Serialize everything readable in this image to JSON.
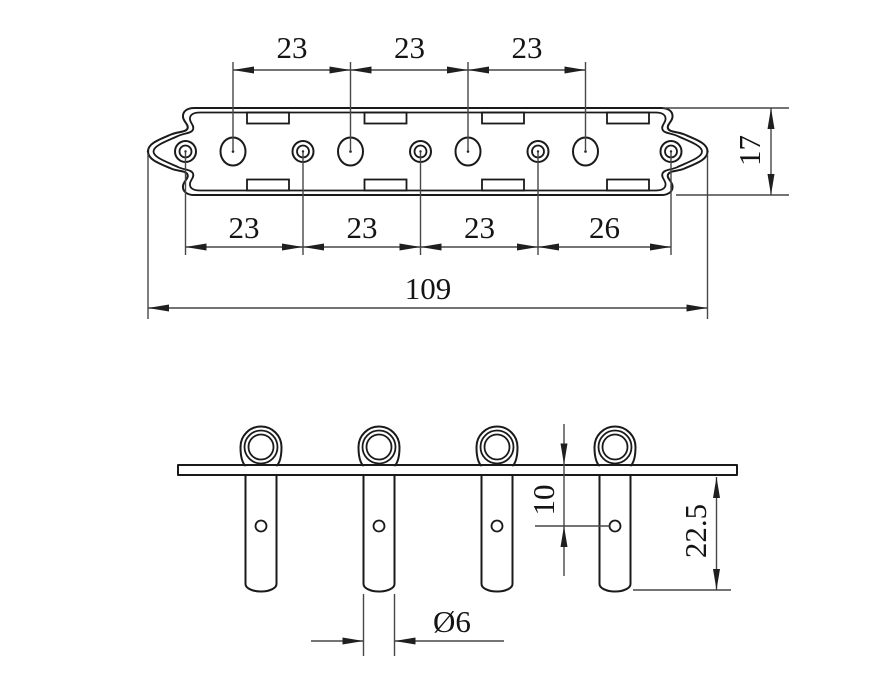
{
  "drawing": {
    "views": [
      "plan-view-plate",
      "front-view-posts"
    ],
    "colors": {
      "background": "#ffffff",
      "geometry_line": "#1a1a1a",
      "dimension_line": "#474747",
      "text": "#141414"
    },
    "dims": {
      "top": [
        "23",
        "23",
        "23"
      ],
      "bottom": [
        "23",
        "23",
        "23",
        "26"
      ],
      "overall": "109",
      "plate_height": "17",
      "hole_offset": "10",
      "post_length": "22.5",
      "post_diameter": "Ø6"
    }
  }
}
